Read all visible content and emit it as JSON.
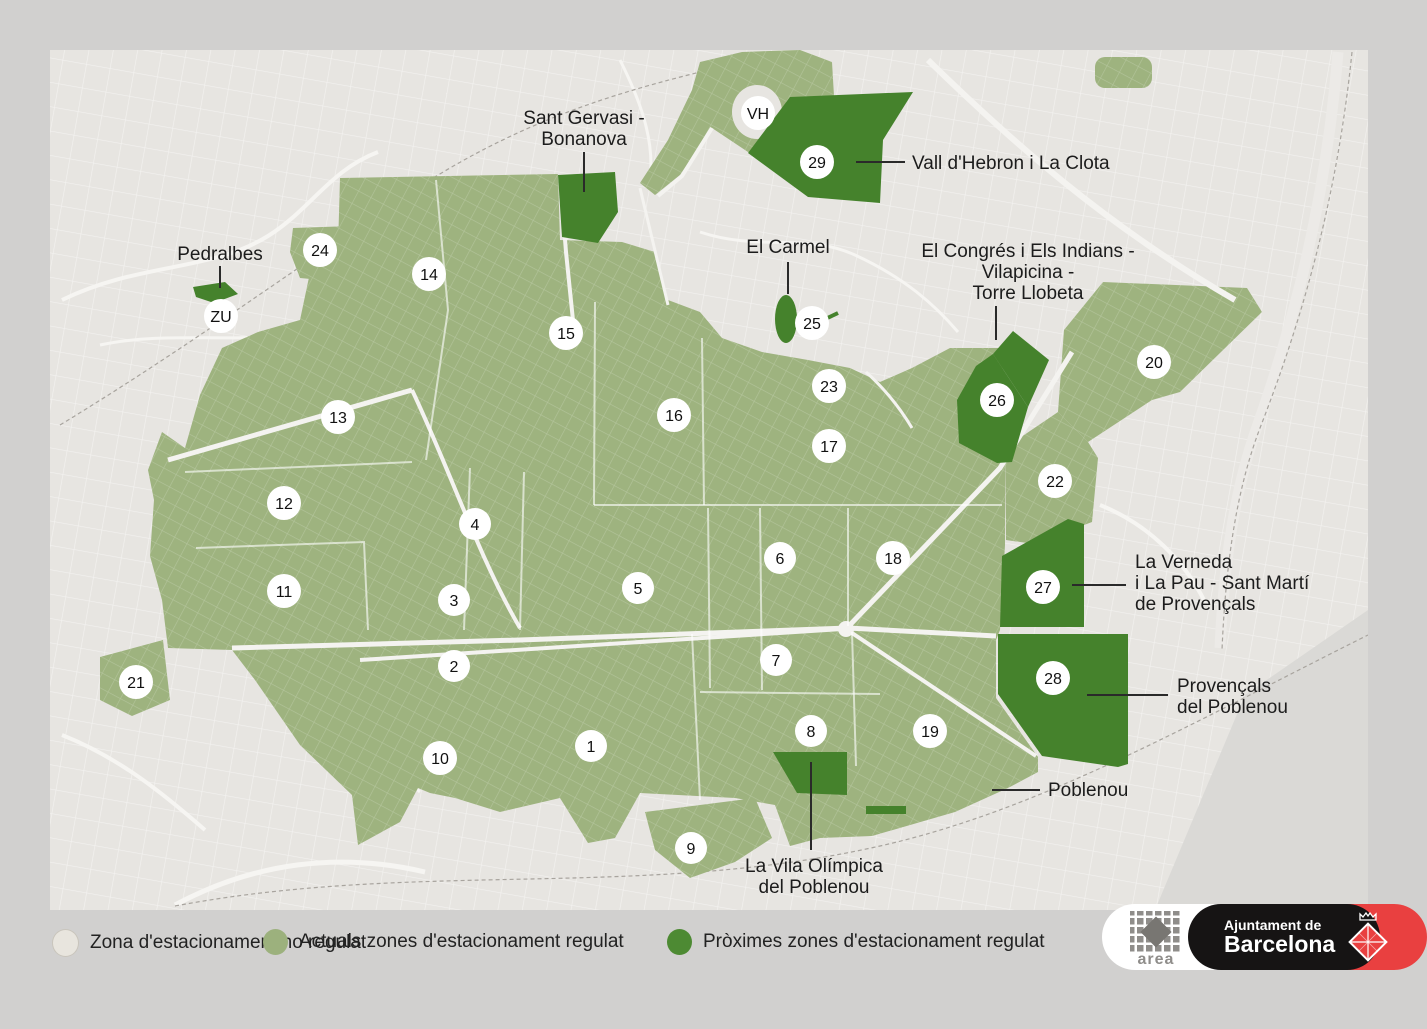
{
  "title": "Ampliacions AREA 2020",
  "legend": {
    "items": [
      {
        "label": "Zona d'estacionament no regulat",
        "color": "#e8e5de"
      },
      {
        "label": "Actuals zones d'estacionament regulat",
        "color": "#9cb17d"
      },
      {
        "label": "Pròximes zones d'estacionament regulat",
        "color": "#4d8a33"
      }
    ]
  },
  "logos": {
    "area": "area",
    "cityhall_line1": "Ajuntament de",
    "cityhall_line2": "Barcelona"
  },
  "colors": {
    "background": "#d1d0cf",
    "map_base": "#e7e5e1",
    "zone_current": "#9eb37f",
    "zone_next": "#45822c",
    "sea": "#dad9d6",
    "accent_red": "#e94040"
  },
  "map": {
    "zones": [
      {
        "label": "1",
        "x": 591,
        "y": 746
      },
      {
        "label": "2",
        "x": 454,
        "y": 666
      },
      {
        "label": "3",
        "x": 454,
        "y": 600
      },
      {
        "label": "4",
        "x": 475,
        "y": 524
      },
      {
        "label": "5",
        "x": 638,
        "y": 588
      },
      {
        "label": "6",
        "x": 780,
        "y": 558
      },
      {
        "label": "7",
        "x": 776,
        "y": 660
      },
      {
        "label": "8",
        "x": 811,
        "y": 731
      },
      {
        "label": "9",
        "x": 691,
        "y": 848
      },
      {
        "label": "10",
        "x": 440,
        "y": 758
      },
      {
        "label": "11",
        "x": 284,
        "y": 591
      },
      {
        "label": "12",
        "x": 284,
        "y": 503
      },
      {
        "label": "13",
        "x": 338,
        "y": 417
      },
      {
        "label": "14",
        "x": 429,
        "y": 274
      },
      {
        "label": "15",
        "x": 566,
        "y": 333
      },
      {
        "label": "16",
        "x": 674,
        "y": 415
      },
      {
        "label": "17",
        "x": 829,
        "y": 446
      },
      {
        "label": "18",
        "x": 893,
        "y": 558
      },
      {
        "label": "19",
        "x": 930,
        "y": 731
      },
      {
        "label": "20",
        "x": 1154,
        "y": 362
      },
      {
        "label": "21",
        "x": 136,
        "y": 682
      },
      {
        "label": "22",
        "x": 1055,
        "y": 481
      },
      {
        "label": "23",
        "x": 829,
        "y": 386
      },
      {
        "label": "24",
        "x": 320,
        "y": 250
      },
      {
        "label": "25",
        "x": 812,
        "y": 323
      },
      {
        "label": "26",
        "x": 997,
        "y": 400
      },
      {
        "label": "27",
        "x": 1043,
        "y": 587
      },
      {
        "label": "28",
        "x": 1053,
        "y": 678
      },
      {
        "label": "29",
        "x": 817,
        "y": 162
      },
      {
        "label": "VH",
        "x": 758,
        "y": 113
      },
      {
        "label": "ZU",
        "x": 221,
        "y": 316
      }
    ],
    "labels": [
      {
        "id": "sant-gervasi",
        "lines": [
          "Sant Gervasi -",
          "Bonanova"
        ],
        "x": 584,
        "y": 124,
        "align": "middle",
        "leader": {
          "x1": 584,
          "y1": 152,
          "x2": 584,
          "y2": 192
        }
      },
      {
        "id": "vall-hebron",
        "lines": [
          "Vall d'Hebron i La Clota"
        ],
        "x": 912,
        "y": 169,
        "align": "start",
        "leader": {
          "x1": 856,
          "y1": 162,
          "x2": 905,
          "y2": 162
        }
      },
      {
        "id": "el-carmel",
        "lines": [
          "El Carmel"
        ],
        "x": 788,
        "y": 253,
        "align": "middle",
        "leader": {
          "x1": 788,
          "y1": 262,
          "x2": 788,
          "y2": 294
        }
      },
      {
        "id": "el-congres",
        "lines": [
          "El Congrés i Els Indians -",
          "Vilapicina -",
          "Torre Llobeta"
        ],
        "x": 1028,
        "y": 257,
        "align": "middle",
        "leader": {
          "x1": 996,
          "y1": 306,
          "x2": 996,
          "y2": 340
        }
      },
      {
        "id": "pedralbes",
        "lines": [
          "Pedralbes"
        ],
        "x": 220,
        "y": 260,
        "align": "middle",
        "leader": {
          "x1": 220,
          "y1": 266,
          "x2": 220,
          "y2": 288
        }
      },
      {
        "id": "la-verneda",
        "lines": [
          "La Verneda",
          "i La Pau - Sant Martí",
          "de Provençals"
        ],
        "x": 1135,
        "y": 568,
        "align": "start",
        "leader": {
          "x1": 1072,
          "y1": 585,
          "x2": 1126,
          "y2": 585
        }
      },
      {
        "id": "provencals",
        "lines": [
          "Provençals",
          "del Poblenou"
        ],
        "x": 1177,
        "y": 692,
        "align": "start",
        "leader": {
          "x1": 1087,
          "y1": 695,
          "x2": 1168,
          "y2": 695
        }
      },
      {
        "id": "poblenou",
        "lines": [
          "Poblenou"
        ],
        "x": 1048,
        "y": 796,
        "align": "start",
        "leader": {
          "x1": 992,
          "y1": 790,
          "x2": 1040,
          "y2": 790
        }
      },
      {
        "id": "vila-olimpica",
        "lines": [
          "La Vila Olímpica",
          "del Poblenou"
        ],
        "x": 814,
        "y": 872,
        "align": "middle",
        "leader": {
          "x1": 811,
          "y1": 762,
          "x2": 811,
          "y2": 850
        }
      }
    ]
  }
}
